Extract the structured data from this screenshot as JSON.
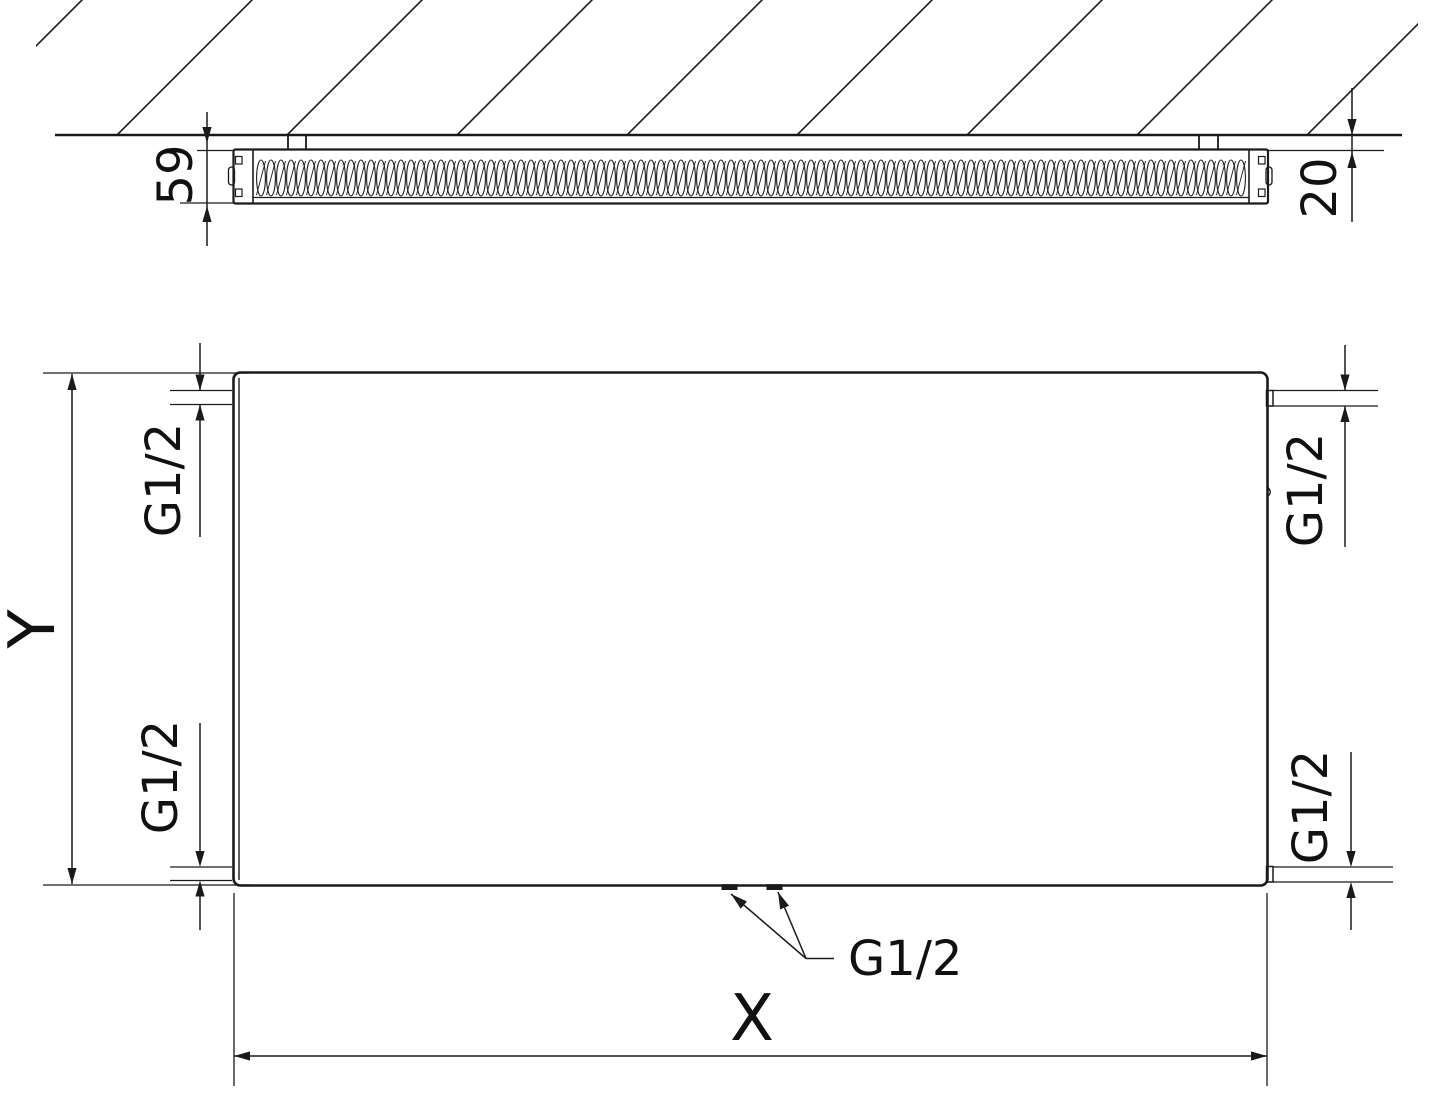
{
  "colors": {
    "line": "#1a1a1a",
    "background": "#ffffff"
  },
  "top_view": {
    "depth_dim": "59",
    "wall_distance_dim": "20"
  },
  "front_view": {
    "height_dim": "Y",
    "width_dim": "X",
    "top_left_connection": "G1/2",
    "top_right_connection": "G1/2",
    "bottom_left_connection": "G1/2",
    "bottom_right_connection": "G1/2",
    "bottom_center_connection": "G1/2"
  }
}
